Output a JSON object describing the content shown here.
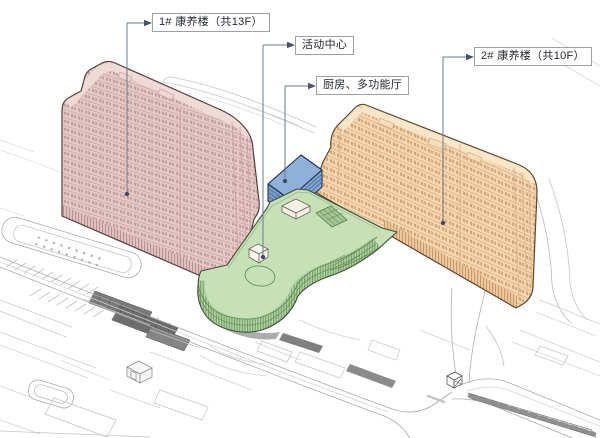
{
  "diagram": {
    "type": "axonometric-site-plan",
    "annotations": [
      {
        "id": "building1",
        "text": "1# 康养楼（共13F）"
      },
      {
        "id": "activity_center",
        "text": "活动中心"
      },
      {
        "id": "kitchen_hall",
        "text": "厨房、多功能厅"
      },
      {
        "id": "building2",
        "text": "2# 康养楼（共10F）"
      }
    ],
    "colors": {
      "building1_fill": "#e8cbc9",
      "building2_fill": "#f5d7b0",
      "activity_center_fill": "#8fb0d8",
      "podium_fill": "#c6e0b8",
      "leader_line": "#6e7a8a",
      "site_line": "#bdbdbd"
    }
  }
}
